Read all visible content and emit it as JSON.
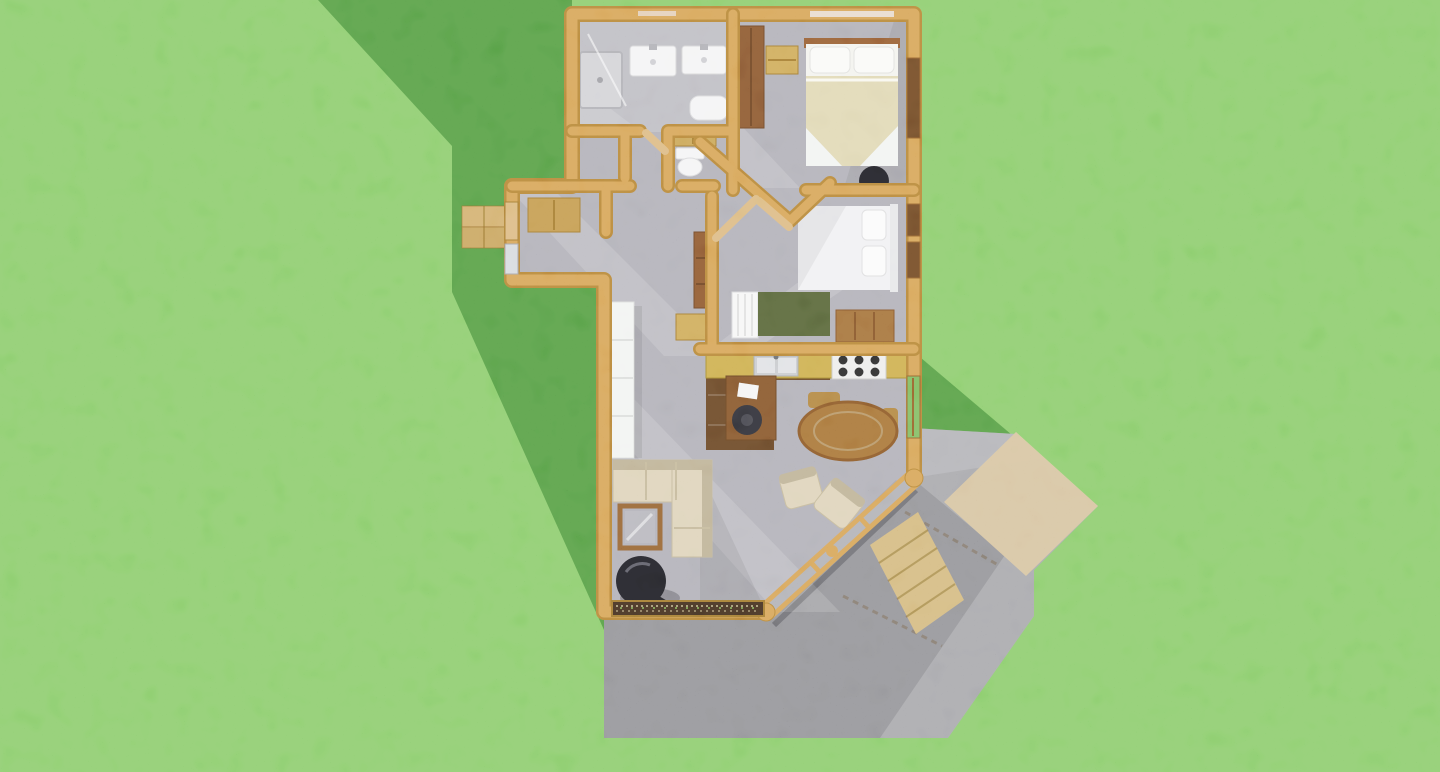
{
  "scene": {
    "description": "Top-down 3D dollhouse rendering of a small single-storey house floor plan on a green lawn, with a grey concrete patio at the lower right, a wood walkway, and the house shadow cast onto the grass at the left",
    "view": "overhead 3D floor-plan render",
    "background": "lawn grass"
  },
  "colors": {
    "grass": "#6fbe56",
    "grassShadow": "#3f7d33",
    "wall": "#cb8b45",
    "wallDark": "#a26a2b",
    "wallLight": "#e3aa60",
    "doorWood": "#d2a768",
    "carpet": "#9b9aa3",
    "carpetLight": "#bdbcc4",
    "tile": "#abaab2",
    "woodFloor": "#54381f",
    "counter": "#bf983e",
    "patio": "#8f8f94",
    "patioLight": "#b2b2b4",
    "patioShadow": "#6f6f75",
    "tanMat": "#cfb586",
    "walkway": "#c8a666",
    "sofa": "#d4c7a6",
    "sofaDark": "#ab9c78",
    "tableWood": "#8f5d2c",
    "bedBlanket": "#d7cd9f",
    "rug": "#45502c",
    "stoveBlack": "#1b1b1f",
    "darkWood": "#6e4526",
    "white": "#f1f1f2",
    "porchWood": "#c69a58"
  },
  "rooms": [
    {
      "id": "bathroom",
      "label": "Bathroom",
      "furniture": [
        "shower",
        "double-vanity",
        "bathtub"
      ]
    },
    {
      "id": "master-bedroom",
      "label": "Master Bedroom",
      "furniture": [
        "double-bed",
        "wardrobe",
        "dresser",
        "black-stool"
      ]
    },
    {
      "id": "hallway",
      "label": "Hallway",
      "furniture": [
        "toilet",
        "cabinet",
        "bookcase",
        "dresser"
      ]
    },
    {
      "id": "second-bedroom",
      "label": "Second Bedroom",
      "furniture": [
        "single-bed",
        "crib",
        "green-rug",
        "dresser"
      ]
    },
    {
      "id": "kitchen",
      "label": "Kitchen",
      "furniture": [
        "counter",
        "double-sink",
        "range",
        "desk",
        "desk-chair"
      ]
    },
    {
      "id": "dining-area",
      "label": "Dining Area",
      "furniture": [
        "round-table",
        "wood-chairs",
        "armchairs"
      ]
    },
    {
      "id": "living-room",
      "label": "Living Room",
      "furniture": [
        "sectional-sofa",
        "coffee-table",
        "wood-stove",
        "bookshelf",
        "window-planter"
      ]
    },
    {
      "id": "entry",
      "label": "Entry",
      "furniture": [
        "cabinet",
        "porch-steps"
      ]
    }
  ],
  "exterior": {
    "features": [
      "lawn",
      "house-shadow",
      "concrete-patio",
      "paver-mat",
      "wood-walkway",
      "glass-window-wall",
      "porch-steps"
    ]
  }
}
